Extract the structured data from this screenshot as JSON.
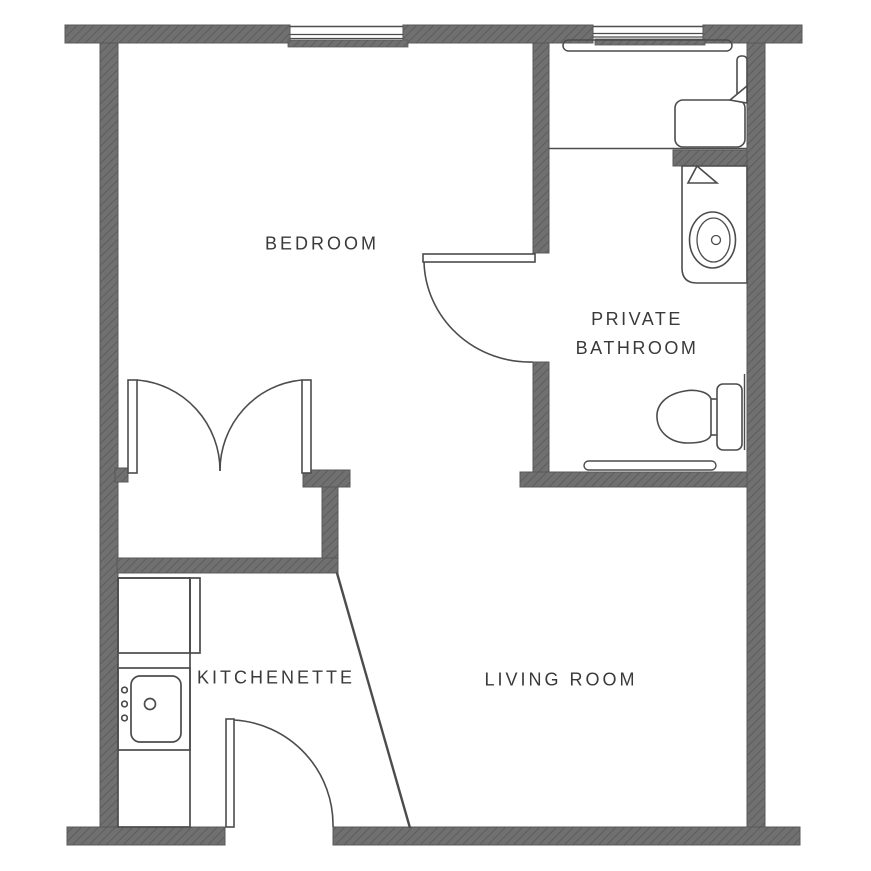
{
  "document": {
    "type": "apartment floor plan",
    "background": "#ffffff"
  },
  "palette": {
    "wall_fill": "#707070",
    "wall_hatch": "#5d5d5d",
    "wall_edge": "#585858",
    "fixture_line": "#4c4c4c",
    "label_text": "#3a3a3a"
  },
  "rooms": {
    "bedroom": {
      "label": "BEDROOM"
    },
    "private_bathroom": {
      "label_line1": "PRIVATE",
      "label_line2": "BATHROOM"
    },
    "kitchenette": {
      "label": "KITCHENETTE"
    },
    "living_room": {
      "label": "LIVING ROOM"
    }
  },
  "fixtures": [
    "bedroom-window",
    "bathroom-window",
    "shower-curtain-rod",
    "closet-double-doors",
    "bathroom-door",
    "entry-door",
    "shower-pan",
    "shower-seat",
    "shower-glass-panel",
    "shower-head-marker",
    "vanity-counter",
    "vanity-sink",
    "vanity-marker",
    "toilet",
    "toilet-grab-bar",
    "wall-grab-bar",
    "kitchen-counter",
    "kitchen-fridge-cabinet",
    "kitchen-sink",
    "diagonal-partition"
  ]
}
